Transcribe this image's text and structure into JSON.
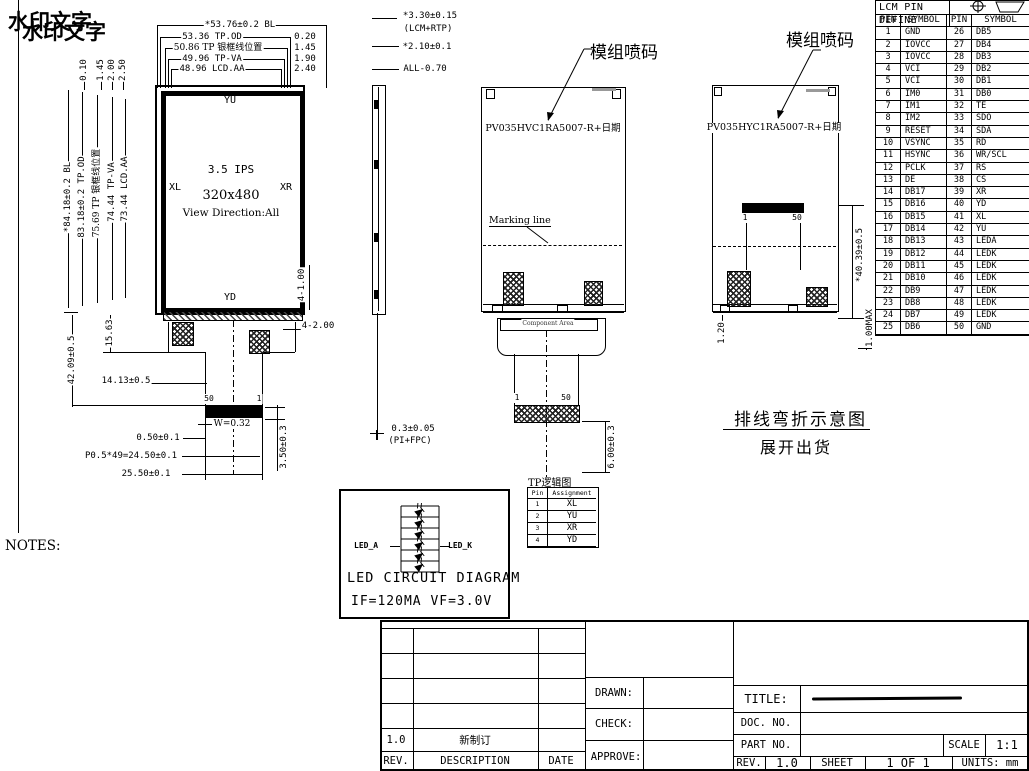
{
  "watermark": {
    "line1": "水印文字",
    "line2": "水印文字"
  },
  "front_view": {
    "top_dims": [
      "*53.76±0.2 BL",
      "53.36 TP.OD",
      "50.86 TP 银框线位置",
      "49.96 TP-VA",
      "48.96 LCD.AA"
    ],
    "top_right_offsets": [
      "0.20",
      "1.45",
      "1.90",
      "2.40"
    ],
    "top_left_offsets": [
      "0.10",
      "1.45",
      "2.00",
      "2.50"
    ],
    "left_dims": [
      "*84.18±0.2 BL",
      "83.18±0.2 TP.OD",
      "75.69 TP 银框线位置",
      "74.44 TP-VA",
      "73.44 LCD.AA"
    ],
    "touch_labels": {
      "top": "YU",
      "left": "XL",
      "right": "XR",
      "bottom": "YD"
    },
    "center": {
      "size": "3.5 IPS",
      "resolution": "320x480",
      "view_direction": "View Direction:All"
    },
    "right_dims": {
      "holes_v": "4-1.00",
      "holes_h": "4-2.00"
    },
    "tail": {
      "d_15": "15.63",
      "d_42": "42.09±0.5",
      "d_14": "14.13±0.5",
      "pin_left": "50",
      "pin_right": "1",
      "w": "W=0.32",
      "d_050": "0.50±0.1",
      "d_pitch": "P0.5*49=24.50±0.1",
      "d_2550": "25.50±0.1",
      "d_350": "3.50±0.3"
    }
  },
  "side_view": {
    "d1": "*3.30±0.15",
    "d1b": "(LCM+RTP)",
    "d2": "*2.10±0.1",
    "d3": "ALL-0.70",
    "d4": "0.3±0.05",
    "d4b": "(PI+FPC)"
  },
  "back_view1": {
    "callout": "模组喷码",
    "code": "PV035HVC1RA5007-R+日期",
    "marking": "Marking line",
    "component_area": "Component Area",
    "pin_left": "1",
    "pin_right": "50",
    "dim": "6.00±0.3"
  },
  "back_view2": {
    "callout": "模组喷码",
    "code": "PV035HYC1RA5007-R+日期",
    "pin_left": "1",
    "pin_right": "50",
    "dim_right": "*40.39±0.5",
    "dim_bl": "1.20",
    "dim_br": "1.00MAX"
  },
  "fold_note": {
    "line1": "排线弯折示意图",
    "line2": "展开出货"
  },
  "pin_table": {
    "title": "LCM PIN DEFINE",
    "headers": [
      "PIN",
      "SYMBOL",
      "PIN",
      "SYMBOL"
    ],
    "rows": [
      [
        "1",
        "GND",
        "26",
        "DB5"
      ],
      [
        "2",
        "IOVCC",
        "27",
        "DB4"
      ],
      [
        "3",
        "IOVCC",
        "28",
        "DB3"
      ],
      [
        "4",
        "VCI",
        "29",
        "DB2"
      ],
      [
        "5",
        "VCI",
        "30",
        "DB1"
      ],
      [
        "6",
        "IM0",
        "31",
        "DB0"
      ],
      [
        "7",
        "IM1",
        "32",
        "TE"
      ],
      [
        "8",
        "IM2",
        "33",
        "SDO"
      ],
      [
        "9",
        "RESET",
        "34",
        "SDA"
      ],
      [
        "10",
        "VSYNC",
        "35",
        "RD"
      ],
      [
        "11",
        "HSYNC",
        "36",
        "WR/SCL"
      ],
      [
        "12",
        "PCLK",
        "37",
        "RS"
      ],
      [
        "13",
        "DE",
        "38",
        "CS"
      ],
      [
        "14",
        "DB17",
        "39",
        "XR"
      ],
      [
        "15",
        "DB16",
        "40",
        "YD"
      ],
      [
        "16",
        "DB15",
        "41",
        "XL"
      ],
      [
        "17",
        "DB14",
        "42",
        "YU"
      ],
      [
        "18",
        "DB13",
        "43",
        "LEDA"
      ],
      [
        "19",
        "DB12",
        "44",
        "LEDK"
      ],
      [
        "20",
        "DB11",
        "45",
        "LEDK"
      ],
      [
        "21",
        "DB10",
        "46",
        "LEDK"
      ],
      [
        "22",
        "DB9",
        "47",
        "LEDK"
      ],
      [
        "23",
        "DB8",
        "48",
        "LEDK"
      ],
      [
        "24",
        "DB7",
        "49",
        "LEDK"
      ],
      [
        "25",
        "DB6",
        "50",
        "GND"
      ]
    ]
  },
  "tp_table": {
    "title": "TP逻辑图",
    "headers": [
      "Pin",
      "Assignment"
    ],
    "rows": [
      [
        "1",
        "XL"
      ],
      [
        "2",
        "YU"
      ],
      [
        "3",
        "XR"
      ],
      [
        "4",
        "YD"
      ]
    ]
  },
  "led_diagram": {
    "anode": "LED_A",
    "cathode": "LED_K",
    "title": "LED CIRCUIT DIAGRAM",
    "spec": "IF=120MA VF=3.0V"
  },
  "notes": {
    "title": "NOTES:",
    "items": [
      "1、Display type: 3.5″ HVGA",
      "2、Viewing direction: ALL",
      "3、Drive IC: ILI9488",
      "4、Backlight color: 6 LED  WHITE",
      "5、Operation temperature: -20~70° C",
      "6、Storage temperature: -30~80° C",
      "7、LCM Operating Voltage:Vdd=2.8V",
      "8、VAmds: 模块可视区域，建议外壳可视区",
      "域比VAmds单边小0.3以上"
    ]
  },
  "title_block": {
    "rev_header": "REV.",
    "desc_header": "DESCRIPTION",
    "date_header": "DATE",
    "rev_row": {
      "rev": "1.0",
      "desc": "新制订",
      "date": ""
    },
    "drawn": "DRAWN:",
    "check": "CHECK:",
    "approve": "APPROVE:",
    "title_label": "TITLE:",
    "doc_label": "DOC. NO.",
    "part_label": "PART NO.",
    "scale_label": "SCALE",
    "scale_value": "1:1",
    "rev_label": "REV.",
    "rev_value": "1.0",
    "sheet_label": "SHEET",
    "sheet_value": "1 OF 1",
    "units_label": "UNITS: mm"
  }
}
